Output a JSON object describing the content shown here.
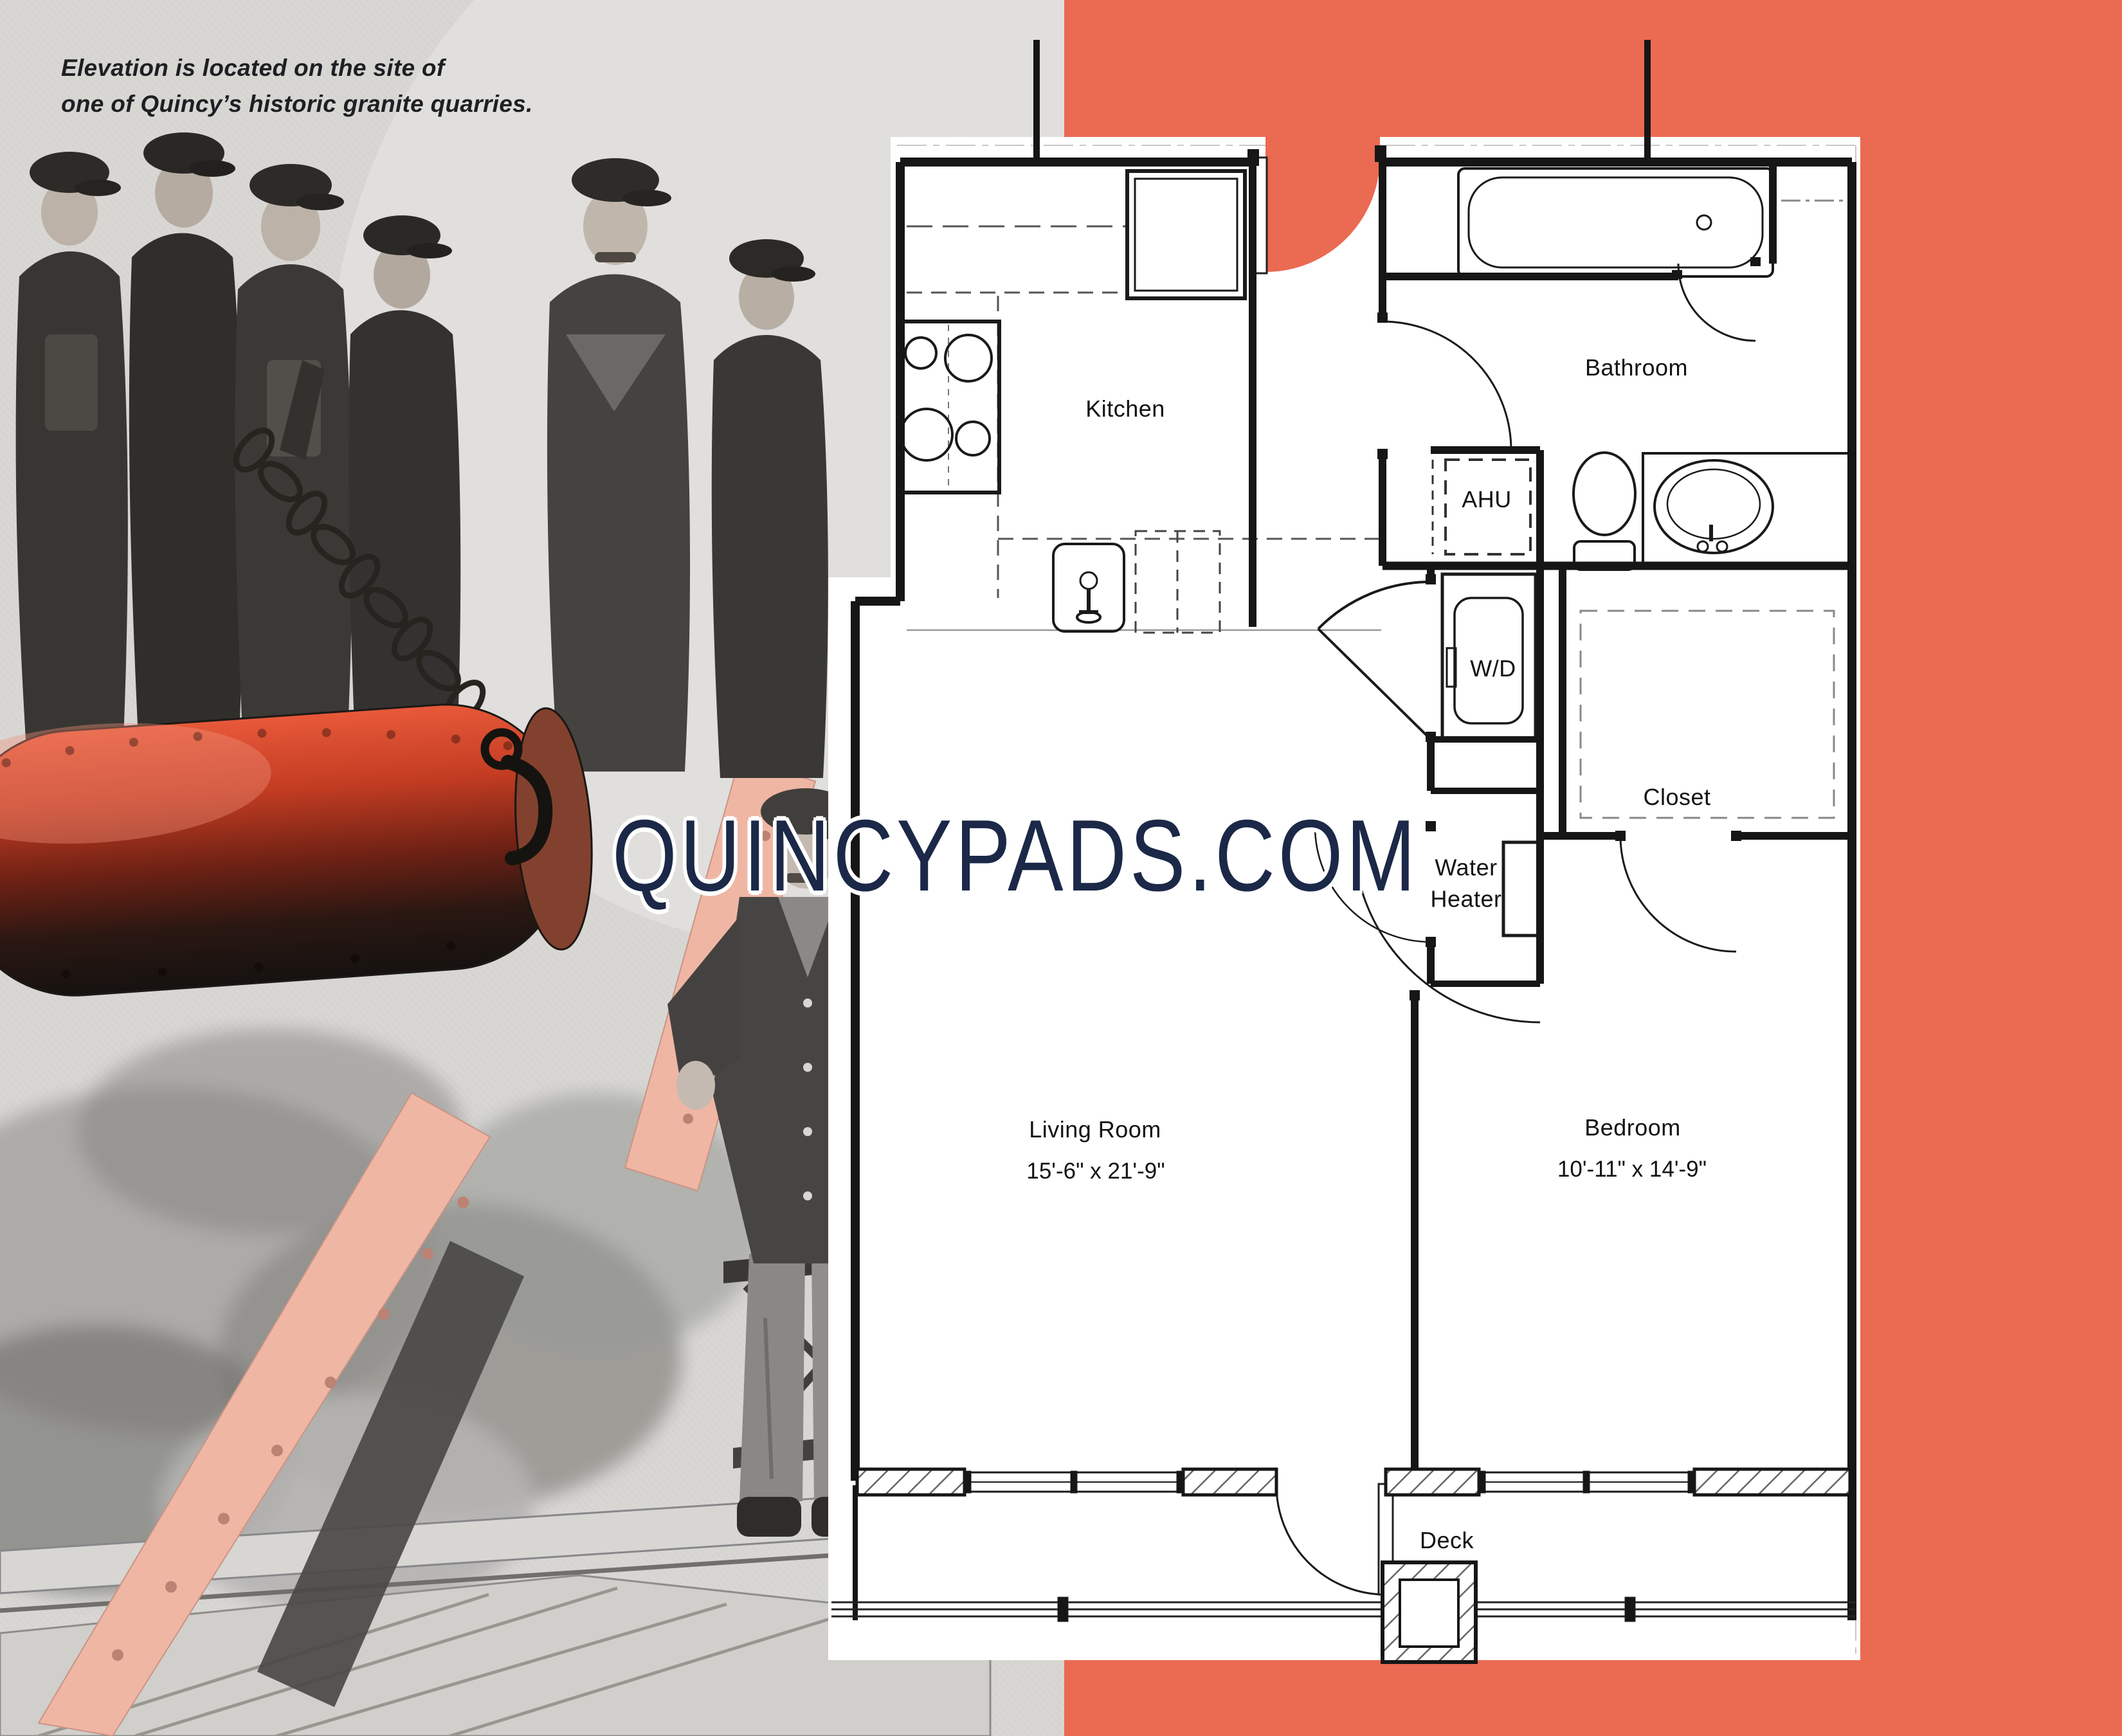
{
  "caption": {
    "line1": "Elevation is located on the site of",
    "line2": "one of Quincy’s historic granite quarries."
  },
  "watermark": "QUINCYPADS.COM",
  "colors": {
    "accent_orange": "#EB6A52",
    "photo_gray": "#D8D7D4",
    "navy_watermark": "#1B2847",
    "pink_beam": "#EFB6A4",
    "granite_block_red": "#DD4F30",
    "plan_line": "#161616"
  },
  "floorplan": {
    "rooms": [
      {
        "id": "kitchen",
        "label": "Kitchen"
      },
      {
        "id": "bathroom",
        "label": "Bathroom"
      },
      {
        "id": "ahu",
        "label": "AHU"
      },
      {
        "id": "washer-dryer",
        "label": "W/D"
      },
      {
        "id": "water-heater",
        "label": "Water Heater"
      },
      {
        "id": "closet",
        "label": "Closet"
      },
      {
        "id": "living-room",
        "label": "Living Room",
        "dimensions": "15'-6\" x 21'-9\""
      },
      {
        "id": "bedroom",
        "label": "Bedroom",
        "dimensions": "10'-11\" x 14'-9\""
      },
      {
        "id": "deck",
        "label": "Deck"
      }
    ],
    "fixtures": [
      "bathtub",
      "toilet",
      "vanity-sink",
      "stove",
      "refrigerator",
      "kitchen-sink",
      "island",
      "washer",
      "water-heater-tank",
      "deck-post"
    ]
  },
  "photo": {
    "subject": "Quarry workers with a large suspended granite block, lifting chain, derrick beams and wooden staging"
  }
}
